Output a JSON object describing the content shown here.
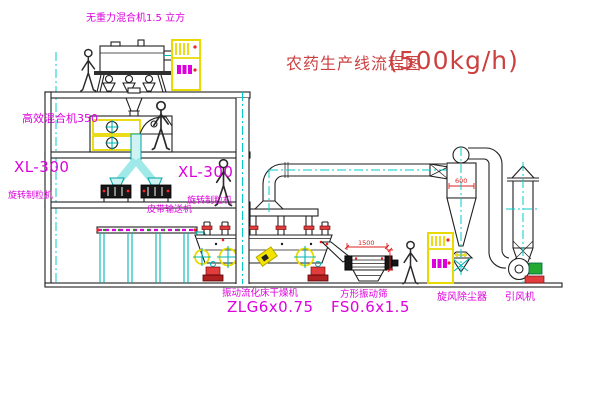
{
  "title": {
    "text": "农药生产线流程图",
    "capacity": "(500kg/h)"
  },
  "equipment_labels": {
    "gravity_free_mixer": "无重力混合机1.5 立方",
    "high_efficiency_mixer": "高效混合机350",
    "granulator_left": {
      "model": "XL-300",
      "name": "旋转制粒机"
    },
    "granulator_right": {
      "model": "XL-300",
      "name": "旋转制粒机"
    },
    "belt_conveyor": "皮带输送机",
    "dryer": {
      "name": "振动流化床干燥机",
      "model": "ZLG6x0.75"
    },
    "sieve": {
      "name": "方形振动筛",
      "model": "FS0.6x1.5"
    },
    "cyclone": "旋风除尘器",
    "fan": "引风机"
  },
  "dimensions": {
    "cyclone_diameter": "600",
    "sieve_length": "1500"
  },
  "colors": {
    "label_magenta": "#dd00dd",
    "annotation_red": "#cc4040",
    "line_cyan": "#00bbbb",
    "panel_yellow": "#f2e400"
  }
}
